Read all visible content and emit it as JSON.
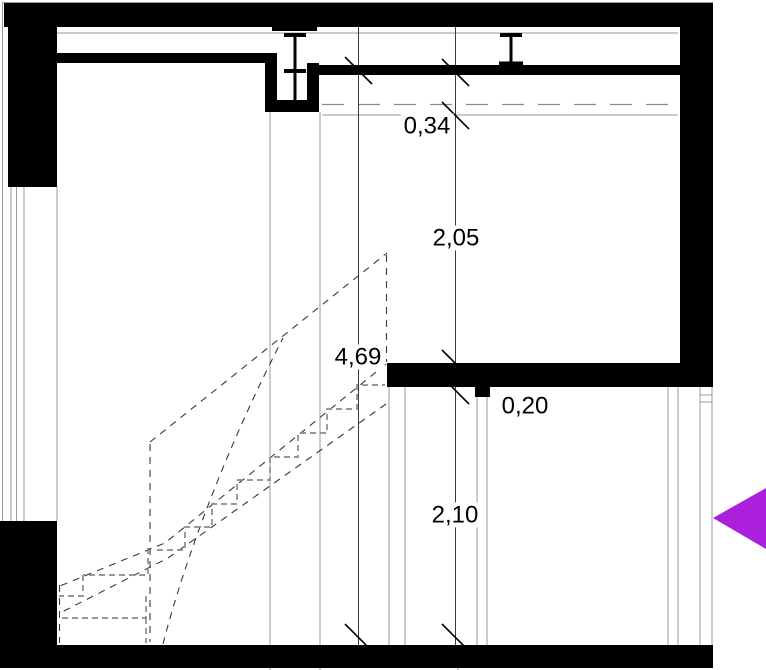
{
  "drawing": {
    "title": "Building section through staircase (CAD drawing)",
    "dimensions": {
      "segment_top": "0,34",
      "segment_upper_room": "2,05",
      "slab_thickness": "0,20",
      "segment_lower_room": "2,10",
      "total_height": "4,69"
    },
    "colors": {
      "wall_fill": "#000000",
      "thin_line": "#999999",
      "dashed_gray": "#8a8a8a",
      "dimension_line": "#3a3a3a",
      "text": "#000000",
      "arrow": "#ab20da",
      "background": "#ffffff"
    }
  }
}
